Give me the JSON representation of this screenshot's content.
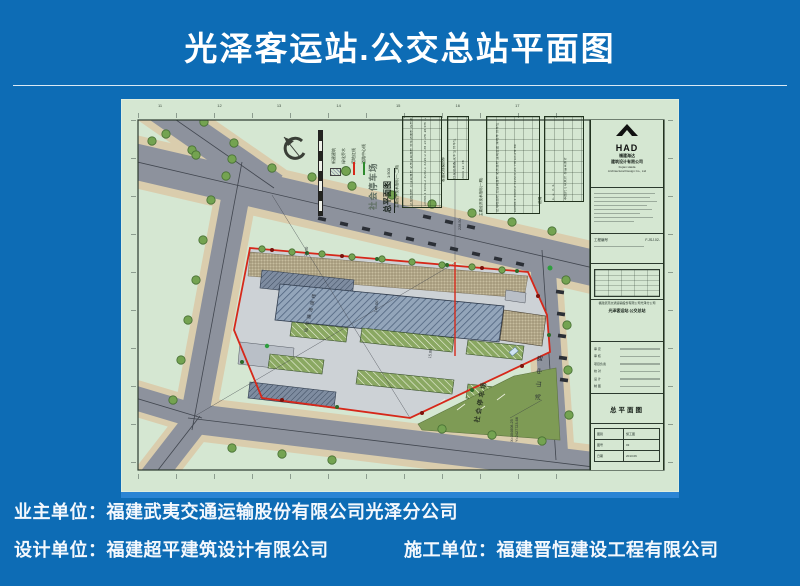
{
  "poster": {
    "title": "光泽客运站.公交总站平面图",
    "footer": {
      "line1": "业主单位：福建武夷交通运输股份有限公司光泽分公司",
      "line2_left": "设计单位：福建超平建筑设计有限公司",
      "line2_right": "施工单位：福建晋恒建设工程有限公司"
    }
  },
  "sheet": {
    "ruler": {
      "top": "11 12 13 14 15 16 17"
    },
    "viewtitle": {
      "name": "总平面图",
      "scale": "1:500"
    },
    "legend": {
      "big_label": "社会停车场",
      "items": [
        {
          "symbol": "building-hatch",
          "label": "新建建筑"
        },
        {
          "symbol": "tree",
          "label": "绿化乔木"
        },
        {
          "symbol": "red-line",
          "label": "用地红线"
        },
        {
          "symbol": "green-line",
          "label": "道路中心线"
        }
      ]
    },
    "labels": {
      "green_area": "社会停车场",
      "road_east": "鸿山中路",
      "road_north": "仙华路连接线",
      "coord_x": "X=304608.25",
      "coord_y": "Y=2427723.68"
    },
    "dims": {
      "d1": "228.50",
      "d2": "146.00",
      "d3": "15.00",
      "d4": "24.50"
    },
    "tables": [
      {
        "title": "主要经济技术指标(一-二期)",
        "items": "总用地面积 总建筑面积 站房建筑面积 停车场面积 容积率 建筑密度 绿地率 停车位",
        "values": "15968.4 6051.2 4050.1 3216.0 0.38 25.4% 18.6% 120"
      },
      {
        "title": "客运站规模指标",
        "items": "日发送旅客 发车位 停车位",
        "values": "3000 12 56"
      },
      {
        "title": "主要经济技术指标(一期)",
        "items": "总用地面积 总建筑面积 站房面积 建筑密度 绿地率 停车位",
        "values": "10968.4 4455.2 3250.4 25.7% 15.2% 86"
      },
      {
        "title": "说明",
        "items": "1. 2. 3. 4.",
        "values": "本图尺寸以米计 标高以米计"
      }
    ],
    "titleblock": {
      "logo": "HAD",
      "company_cn1": "福建海达",
      "company_cn2": "建筑设计有限公司",
      "company_en1": "Fujian Haida",
      "company_en2": "Architectural Design Co., Ltd",
      "field1_label": "工程编号",
      "field1_value": "F.JSJ.02-",
      "owner": "福建武夷交通运输股份有限公司光泽分公司",
      "project": "光泽客运站.公交总站",
      "sigs": [
        {
          "label": "审 定"
        },
        {
          "label": "审 核"
        },
        {
          "label": "项目负责"
        },
        {
          "label": "校 对"
        },
        {
          "label": "设 计"
        },
        {
          "label": "制 图"
        }
      ],
      "drawing_name": "总平面图",
      "bottom": [
        {
          "label": "图别",
          "value": "施工图"
        },
        {
          "label": "图号",
          "value": "03"
        },
        {
          "label": "日期",
          "value": "2013.06"
        }
      ]
    }
  }
}
